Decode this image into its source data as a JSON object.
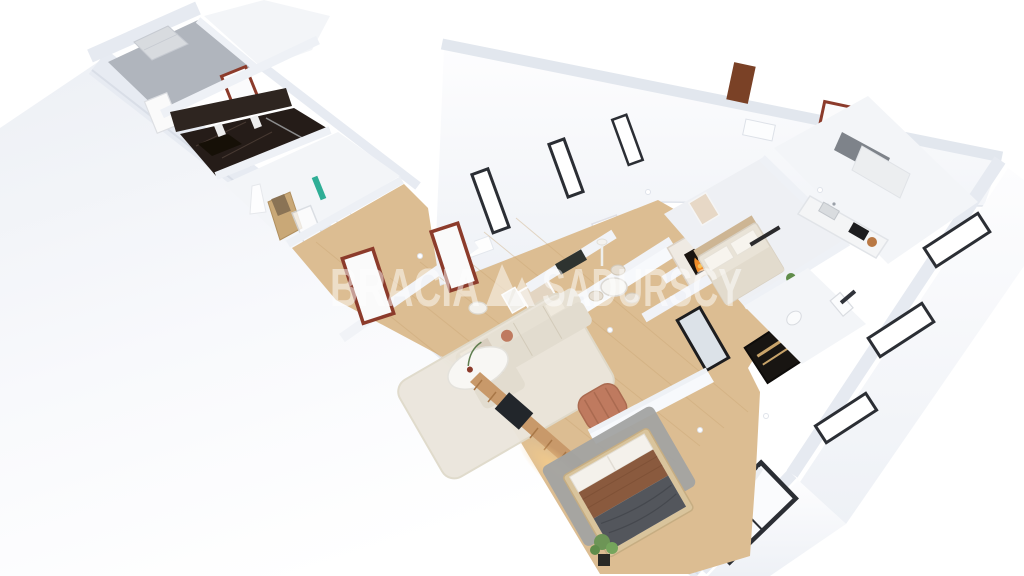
{
  "scene": {
    "type": "3d-floor-plan-render",
    "background": "#ffffff"
  },
  "watermark": {
    "word_left": "BRACIA",
    "word_right": "SADURSCY",
    "logo": "double-triangle-mark",
    "color": "#ffffff",
    "opacity": 0.5
  },
  "palette": {
    "wall_top": "#e6eaf1",
    "wall_face": "#f7f9fc",
    "floor_wood": "#dcbd92",
    "plank_line": "#c9a573",
    "floor_white": "#f3f5f8",
    "floor_gray": "#b0b5bd",
    "bath_marble_dark": "#251c18",
    "rug_cream": "#ebe6dc",
    "rug_gray": "#a2a3a2",
    "sofa_beige": "#e2dccf",
    "armchair_terracotta": "#bf7a5f",
    "bed_frame_wood": "#d9c49c",
    "blanket_brown": "#8a5a3e",
    "blanket_gray": "#53565c",
    "bedding_white": "#f4f1eb",
    "door_frame_red": "#8c3b2b",
    "door_leaf_white": "#fafafa",
    "entry_door_black": "#181512",
    "window_frame_dark": "#2b2e34",
    "fire_orange": "#f08b28",
    "plant_green": "#6d9556",
    "teal_accent": "#2fae96",
    "slat_wood": "#c8996a",
    "glow_warm": "#f7cd8a",
    "kitchen_upper_gray": "#7e838a",
    "counter_white": "#f4f5f6",
    "cooktop_black": "#1d1d1f"
  }
}
